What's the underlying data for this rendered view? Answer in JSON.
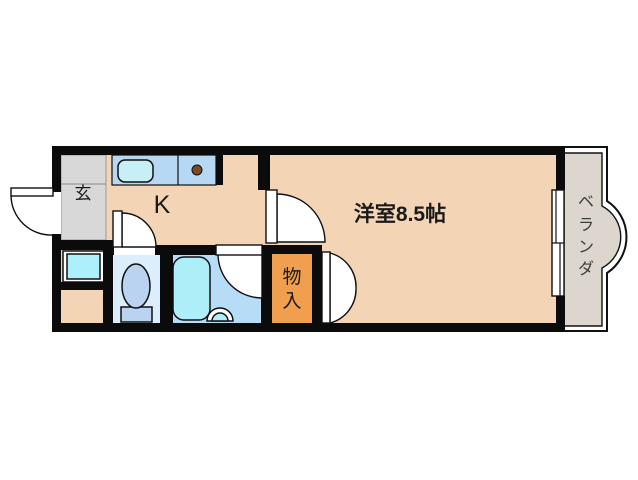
{
  "title": "1K apartment floor plan",
  "colors": {
    "wall": "#0b0b0b",
    "floor": "#f3d5b6",
    "entrance_floor": "#d8d8d8",
    "balcony_floor": "#dcd6ce",
    "counter": "#b7d8f2",
    "sink": "#c7eff6",
    "toilet_floor": "#dcedfb",
    "bath_floor": "#b7dcf6",
    "tub": "#aeeef8",
    "fixture": "#b9d3f0",
    "closet": "#ef9f4d",
    "burner": "#7b4a22",
    "washer_pan": "#adeffa",
    "text": "#1a1a1a",
    "balcony_text": "#3c3c38"
  },
  "labels": {
    "entrance": "玄",
    "kitchen": "K",
    "main_room": "洋室8.5帖",
    "closet": [
      "物",
      "入"
    ],
    "balcony": [
      "ベ",
      "ラ",
      "ン",
      "ダ"
    ]
  }
}
